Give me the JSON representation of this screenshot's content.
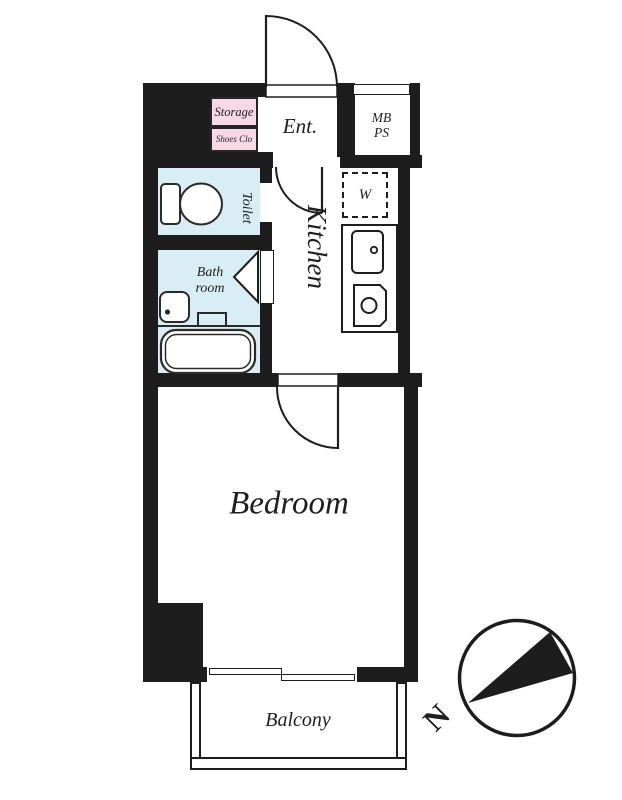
{
  "type": "apartment-floor-plan",
  "labels": {
    "storage": "Storage",
    "shoes_closet": "Shoes Clo",
    "entrance": "Ent.",
    "meter_box_line1": "MB",
    "meter_box_line2": "PS",
    "toilet": "Toilet",
    "washer": "W",
    "kitchen": "Kitchen",
    "bath_line1": "Bath",
    "bath_line2": "room",
    "bedroom": "Bedroom",
    "balcony": "Balcony",
    "compass_north": "N"
  },
  "colors": {
    "wall": "#1d1d1d",
    "wet_area_fill": "#d9edf4",
    "closet_fill": "#f6d9e4",
    "paper": "#ffffff",
    "text": "#1f1f1f"
  }
}
